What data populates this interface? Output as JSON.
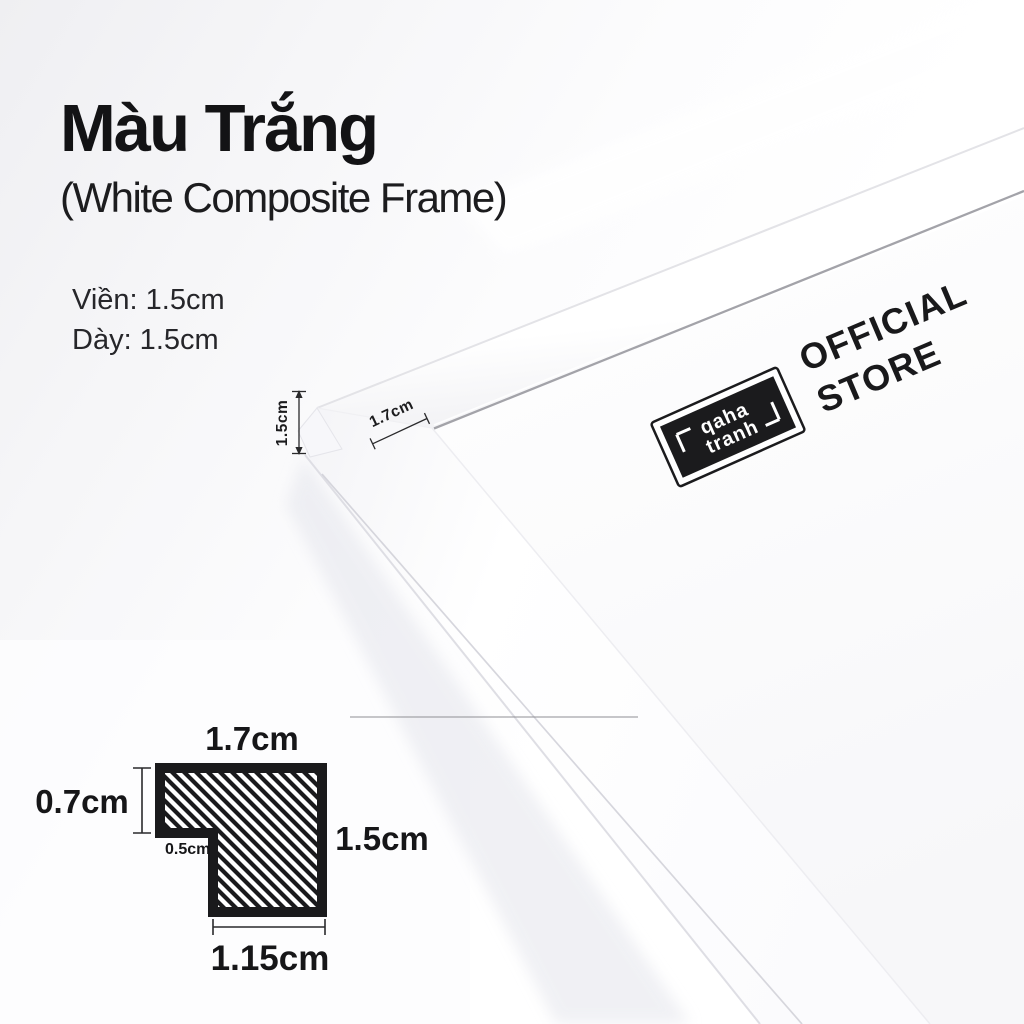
{
  "header": {
    "title": "Màu Trắng",
    "subtitle": "(White Composite Frame)"
  },
  "specs": {
    "line1": "Viền: 1.5cm",
    "line2": "Dày: 1.5cm"
  },
  "photo": {
    "thickness_label": "1.5cm",
    "lip_label": "1.7cm",
    "stamp": {
      "brand_top": "qaha",
      "brand_bottom": "tranh",
      "official": "OFFICIAL",
      "store": "STORE"
    }
  },
  "cross_section": {
    "top_width": "1.7cm",
    "left_height": "0.7cm",
    "step_width": "0.5cm",
    "right_height": "1.5cm",
    "bottom_width": "1.15cm"
  },
  "colors": {
    "ink": "#151517",
    "stamp_black": "#1b1b1d",
    "hatch_black": "#1a1a1c",
    "background_tint": "#f0f0f3"
  }
}
